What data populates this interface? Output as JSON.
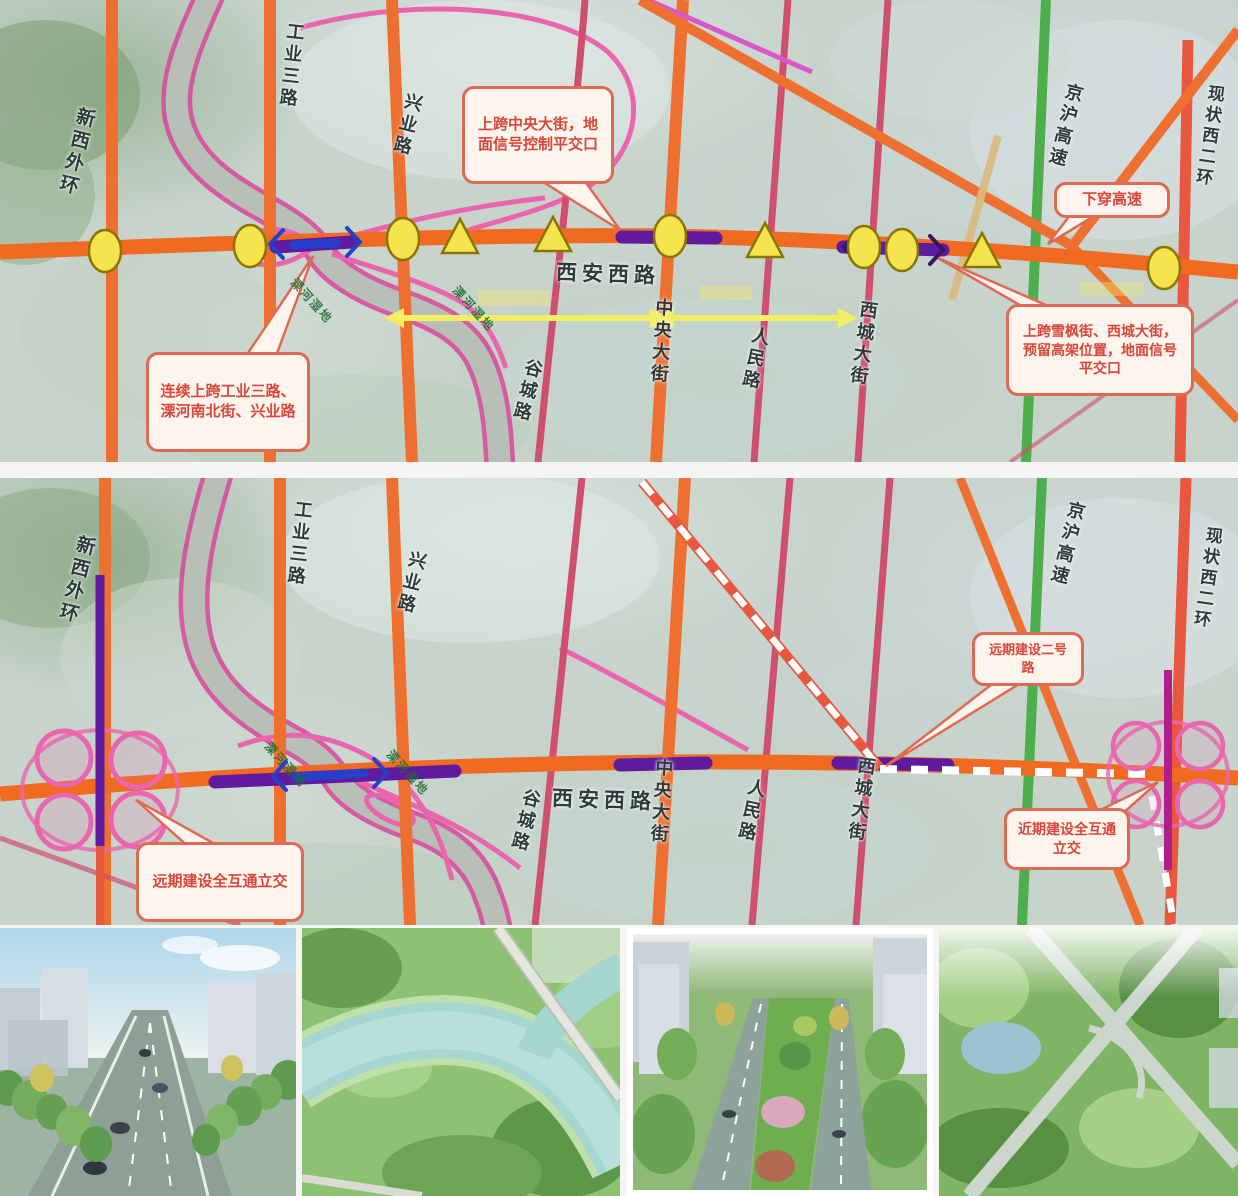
{
  "colors": {
    "road_orange": "#ee7031",
    "road_crimson": "#cf4f6e",
    "expressway_green": "#4fae4c",
    "ring_red": "#e8573f",
    "overpass_purple": "#5f1a9e",
    "bridge_blue": "#2740cc",
    "river_edge_magenta": "#d8459a",
    "marker_yellow": "#f6e44e",
    "callout_text_red": "#d8473a"
  },
  "panel1": {
    "main_road_label": "西安西路",
    "roads": [
      {
        "label": "新西外环"
      },
      {
        "label": "工业三路"
      },
      {
        "label": "兴业路"
      },
      {
        "label": "谷城路"
      },
      {
        "label": "中央大街"
      },
      {
        "label": "人民路"
      },
      {
        "label": "西城大街"
      },
      {
        "label": "京沪高速"
      },
      {
        "label": "现状西二环"
      }
    ],
    "river_labels": [
      {
        "label": "溧河湿地"
      },
      {
        "label": "溧河湿地"
      }
    ],
    "callouts": [
      {
        "text": "上跨中央大街，地面信号控制平交口"
      },
      {
        "text": "下穿高速"
      },
      {
        "text": "连续上跨工业三路、溧河南北街、兴业路"
      },
      {
        "text": "上跨雪枫街、西城大街，预留高架位置，地面信号平交口"
      }
    ]
  },
  "panel2": {
    "main_road_label": "西安西路",
    "roads": [
      {
        "label": "新西外环"
      },
      {
        "label": "工业三路"
      },
      {
        "label": "兴业路"
      },
      {
        "label": "谷城路"
      },
      {
        "label": "中央大街"
      },
      {
        "label": "人民路"
      },
      {
        "label": "西城大街"
      },
      {
        "label": "京沪高速"
      },
      {
        "label": "现状西二环"
      }
    ],
    "river_labels": [
      {
        "label": "溧河湿地"
      },
      {
        "label": "溧河湿地"
      }
    ],
    "callouts": [
      {
        "text": "远期建设全互通立交"
      },
      {
        "text": "近期建设全互通立交"
      },
      {
        "text": "远期建设二号路"
      }
    ]
  },
  "photos": [
    {
      "name": "street-level-road-rendering"
    },
    {
      "name": "river-bridge-aerial-rendering"
    },
    {
      "name": "boulevard-median-aerial-rendering"
    },
    {
      "name": "interchange-aerial-rendering"
    }
  ]
}
